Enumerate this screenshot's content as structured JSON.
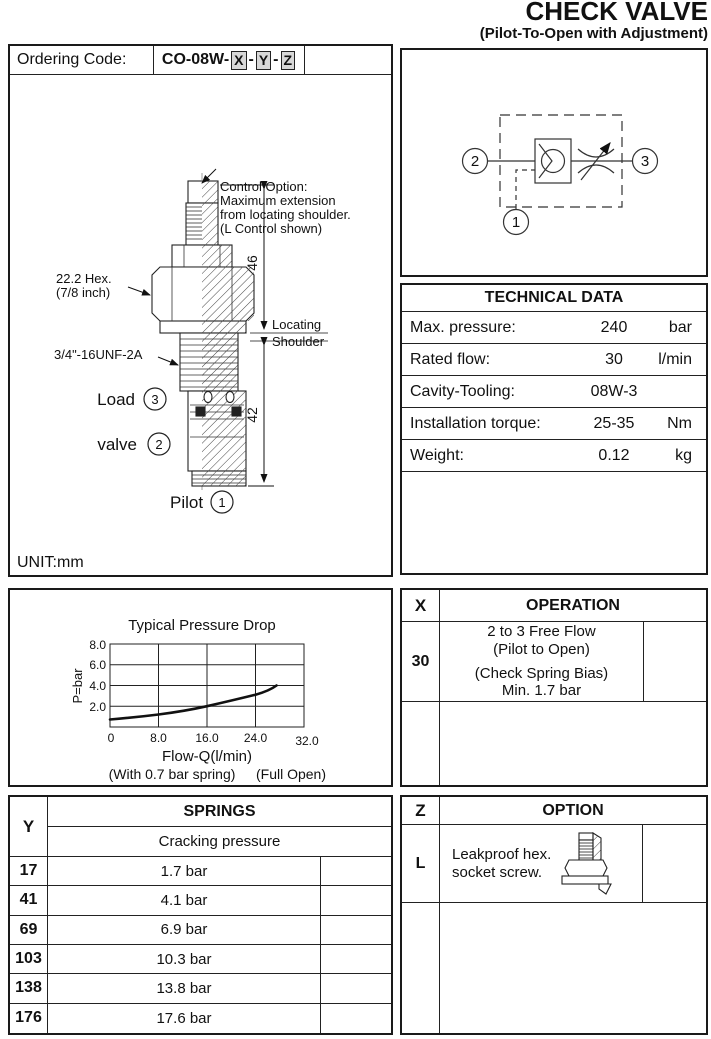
{
  "header": {
    "title": "CHECK VALVE",
    "subtitle": "(Pilot-To-Open with Adjustment)"
  },
  "ordering": {
    "label": "Ordering Code:",
    "prefix": "CO-08W-",
    "x": "X",
    "y": "Y",
    "z": "Z",
    "sep": "-"
  },
  "drawing": {
    "control_note": [
      "Control Option:",
      "Maximum extension",
      "from locating shoulder.",
      "(L Control shown)"
    ],
    "hex1": "22.2 Hex.",
    "hex2": "(7/8 inch)",
    "thread": "3/4\"-16UNF-2A",
    "load_label": "Load",
    "load_num": "3",
    "valve_label": "valve",
    "valve_num": "2",
    "pilot_label": "Pilot",
    "pilot_num": "1",
    "dim46": "46",
    "dim42": "42",
    "loc1": "Locating",
    "loc2": "Shoulder",
    "unit": "UNIT:mm"
  },
  "schematic": {
    "port1": "1",
    "port2": "2",
    "port3": "3"
  },
  "technical": {
    "title": "TECHNICAL DATA",
    "rows": [
      {
        "label": "Max. pressure:",
        "value": "240",
        "unit": "bar"
      },
      {
        "label": "Rated flow:",
        "value": "30",
        "unit": "l/min"
      },
      {
        "label": "Cavity-Tooling:",
        "value": "08W-3",
        "unit": ""
      },
      {
        "label": "Installation torque:",
        "value": "25-35",
        "unit": "Nm"
      },
      {
        "label": "Weight:",
        "value": "0.12",
        "unit": "kg"
      }
    ]
  },
  "chart": {
    "title": "Typical Pressure Drop",
    "ylabel": "P=bar",
    "xlabel": "Flow-Q(l/min)",
    "note1": "(With 0.7 bar spring)",
    "note2": "(Full Open)",
    "yticks": [
      "8.0",
      "6.0",
      "4.0",
      "2.0"
    ],
    "xticks": [
      "0",
      "8.0",
      "16.0",
      "24.0",
      "32.0"
    ]
  },
  "chart_data": {
    "type": "line",
    "title": "Typical Pressure Drop",
    "xlabel": "Flow-Q(l/min)",
    "ylabel": "P=bar",
    "xlim": [
      0,
      32
    ],
    "ylim": [
      0,
      8
    ],
    "xticks": [
      0,
      8,
      16,
      24,
      32
    ],
    "yticks": [
      2,
      4,
      6,
      8
    ],
    "grid": true,
    "series": [
      {
        "name": "(With 0.7 bar spring) (Full Open)",
        "x": [
          0,
          4,
          8,
          12,
          16,
          20,
          24,
          27.5
        ],
        "y": [
          0.7,
          0.95,
          1.2,
          1.55,
          2.0,
          2.5,
          3.1,
          4.0
        ]
      }
    ]
  },
  "operation": {
    "col": "X",
    "title": "OPERATION",
    "code": "30",
    "line1": "2 to 3 Free Flow",
    "line2": "(Pilot to Open)",
    "line3": "(Check Spring Bias)",
    "line4": "Min. 1.7 bar"
  },
  "springs": {
    "col": "Y",
    "title": "SPRINGS",
    "subtitle": "Cracking pressure",
    "rows": [
      {
        "code": "17",
        "value": "1.7 bar"
      },
      {
        "code": "41",
        "value": "4.1 bar"
      },
      {
        "code": "69",
        "value": "6.9 bar"
      },
      {
        "code": "103",
        "value": "10.3 bar"
      },
      {
        "code": "138",
        "value": "13.8 bar"
      },
      {
        "code": "176",
        "value": "17.6 bar"
      }
    ]
  },
  "option": {
    "col": "Z",
    "title": "OPTION",
    "code": "L",
    "line1": "Leakproof hex.",
    "line2": "socket screw."
  }
}
